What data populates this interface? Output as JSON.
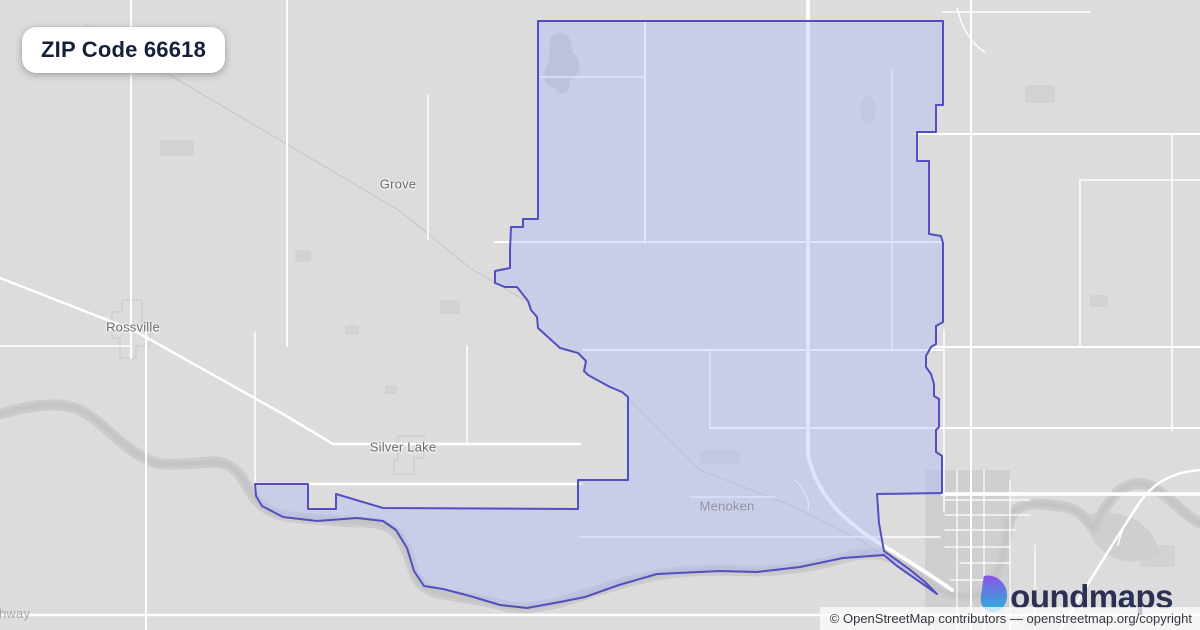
{
  "badge": {
    "label": "ZIP Code 66618"
  },
  "map": {
    "labels": {
      "grove": {
        "text": "Grove"
      },
      "rossville": {
        "text": "Rossville"
      },
      "silver_lake": {
        "text": "Silver Lake"
      },
      "menoken": {
        "text": "Menoken"
      },
      "highway": {
        "text": "hway"
      }
    },
    "boundary_name": "ZIP Code 66618 boundary"
  },
  "logo": {
    "brand": "boundmaps",
    "wordmark": "oundmaps",
    "icon": "boundmaps-b-pin-icon"
  },
  "attribution": {
    "text": "© OpenStreetMap contributors — openstreetmap.org/copyright"
  },
  "colors": {
    "map_bg": "#dcdcdd",
    "road": "#ffffff",
    "patch": "#d2d2d4",
    "river": "#c5c5c8",
    "river_bank": "#cbcbce",
    "boundary_fill": "rgba(172,182,250,0.38)",
    "boundary_stroke": "#544fbe",
    "badge_text": "#16203a",
    "label": "#6b6b6c",
    "label_hamlet": "#8f91a3",
    "label_road": "#a9a9ab",
    "logo_text": "#2b3153",
    "logo_grad_start": "#8a53e6",
    "logo_grad_end": "#26b6d9",
    "attribution_bg": "rgba(255,255,255,0.72)",
    "attribution_text": "#33383d"
  }
}
